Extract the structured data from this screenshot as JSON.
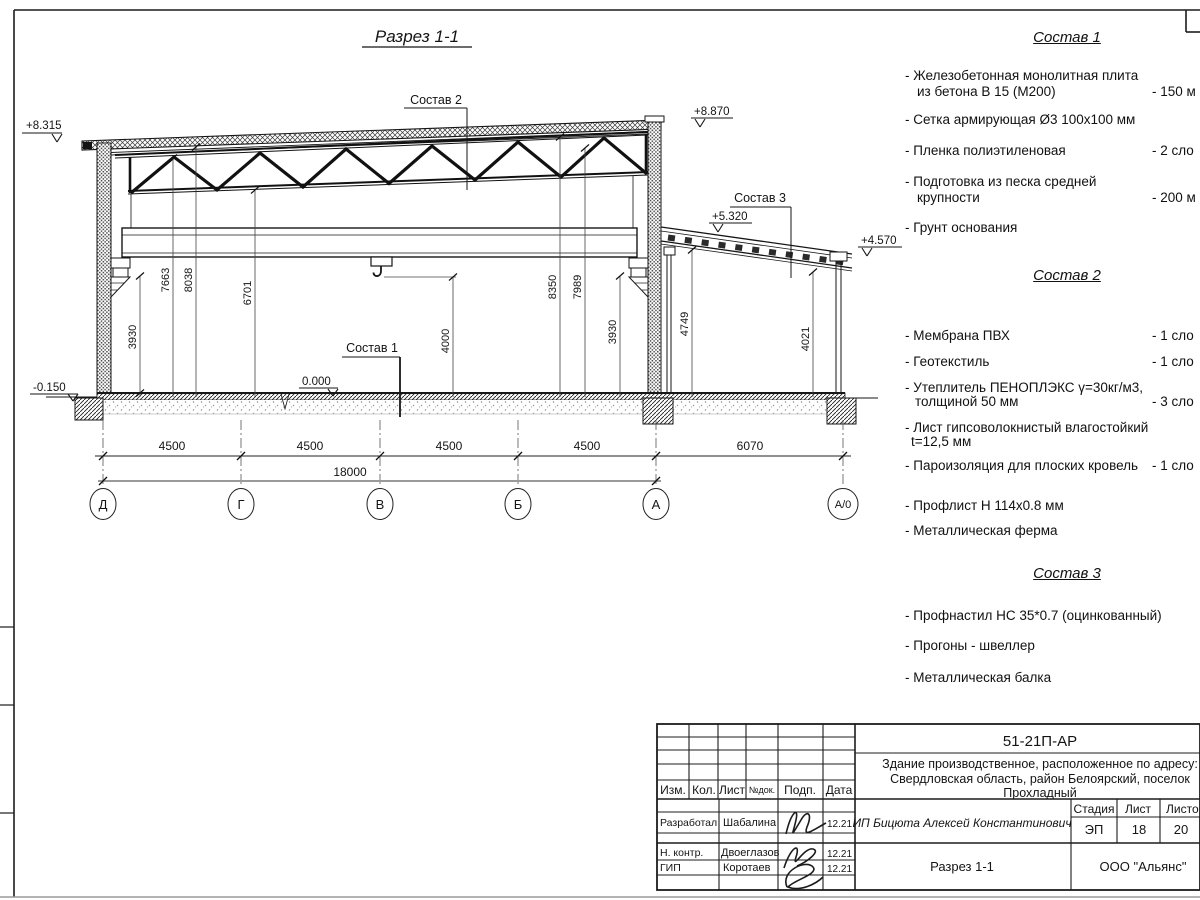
{
  "drawing": {
    "title": "Разрез 1-1",
    "leaders": {
      "sostav1": "Состав 1",
      "sostav2": "Состав 2",
      "sostav3": "Состав 3"
    },
    "elevations": {
      "roof_left": "+8.315",
      "wall_right": "+8.870",
      "annex_high": "+5.320",
      "annex_low": "+4.570",
      "ground": "-0.150",
      "floor": "0.000"
    },
    "vdims": [
      "3930",
      "7663",
      "8038",
      "6701",
      "4000",
      "8350",
      "7989",
      "3930",
      "4749",
      "4021"
    ],
    "hdims": {
      "segments": [
        "4500",
        "4500",
        "4500",
        "4500",
        "6070"
      ],
      "overall": "18000"
    },
    "axes": [
      "Д",
      "Г",
      "В",
      "Б",
      "А",
      "А/0"
    ]
  },
  "materials": {
    "c1": {
      "title": "Состав 1",
      "rows": [
        {
          "t": "- Железобетонная  монолитная плита"
        },
        {
          "t": "из бетона В 15 (М200)",
          "v": "- 150 м"
        },
        {
          "t": "- Сетка армирующая Ø3 100х100 мм"
        },
        {
          "t": "- Пленка полиэтиленовая",
          "v": "- 2 сло"
        },
        {
          "t": "- Подготовка из песка средней"
        },
        {
          "t": "крупности",
          "v": "- 200 м"
        },
        {
          "t": "- Грунт основания"
        }
      ]
    },
    "c2": {
      "title": "Состав 2",
      "rows": [
        {
          "t": "- Мембрана ПВХ",
          "v": "- 1 сло"
        },
        {
          "t": "- Геотекстиль",
          "v": "- 1 сло"
        },
        {
          "t": "- Утеплитель ПЕНОПЛЭКС γ=30кг/м3,"
        },
        {
          "t": "толщиной 50 мм",
          "v": "- 3 сло"
        },
        {
          "t": "- Лист гипсоволокнистый влагостойкий"
        },
        {
          "t": "t=12,5 мм"
        },
        {
          "t": "- Пароизоляция для плоских кровель",
          "v": "- 1 сло"
        },
        {
          "t": "- Профлист Н 114х0.8 мм"
        },
        {
          "t": "- Металлическая ферма"
        }
      ]
    },
    "c3": {
      "title": "Состав 3",
      "rows": [
        {
          "t": "- Профнастил НС 35*0.7 (оцинкованный)"
        },
        {
          "t": "- Прогоны - швеллер"
        },
        {
          "t": "- Металлическая балка"
        }
      ]
    }
  },
  "title_block": {
    "code": "51-21П-АР",
    "description_lines": [
      "Здание производственное, расположенное по адресу:",
      "Свердловская область, район Белоярский, поселок",
      "Прохладный"
    ],
    "client": "ИП Бицюта Алексей Константинович",
    "sheet_title": "Разрез 1-1",
    "company": "ООО \"Альянс\"",
    "header_cols": [
      "Изм.",
      "Кол.",
      "Лист",
      "№док.",
      "Подп.",
      "Дата"
    ],
    "stage_label": "Стадия",
    "sheet_label": "Лист",
    "sheets_label": "Листо",
    "stage": "ЭП",
    "sheet": "18",
    "sheets": "20",
    "rows": [
      {
        "role": "Разработал",
        "name": "Шабалина",
        "date": "12.21"
      },
      {
        "role": "Н. контр.",
        "name": "Двоеглазов",
        "date": "12.21"
      },
      {
        "role": "ГИП",
        "name": "Коротаев",
        "date": "12.21"
      }
    ]
  }
}
